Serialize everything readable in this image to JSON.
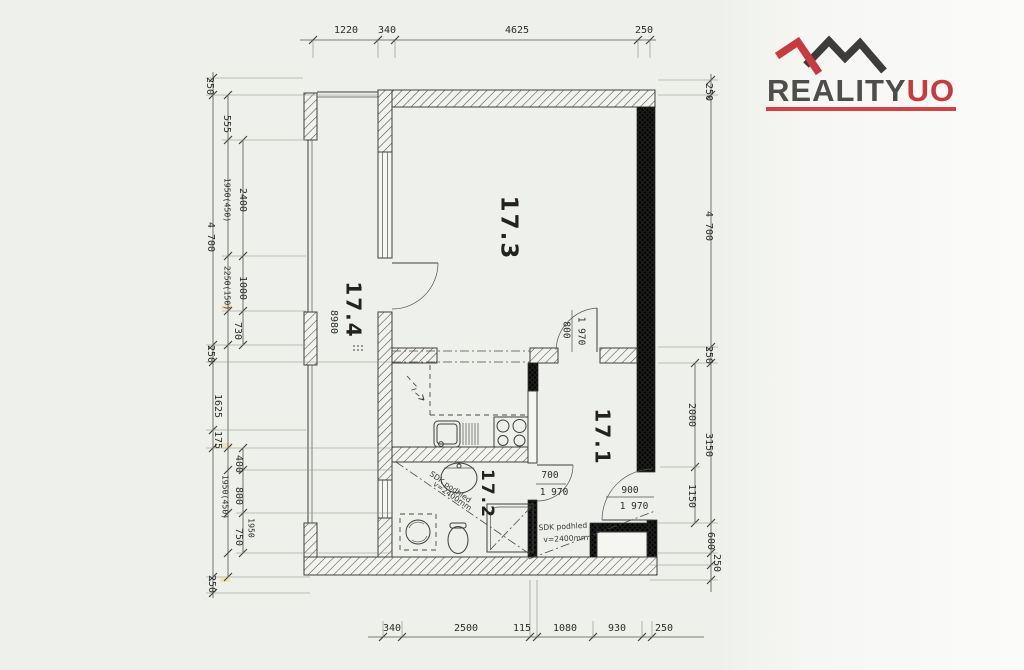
{
  "logo": {
    "brand": "REALITY",
    "accent": "UO",
    "accent_color": "#c93a3c",
    "brand_color": "#4f4c4c"
  },
  "rooms": {
    "living": {
      "label": "17.3"
    },
    "balcony": {
      "label": "17.4",
      "length": "8980"
    },
    "hall": {
      "label": "17.1"
    },
    "bathroom": {
      "label": "17.2"
    }
  },
  "doors": {
    "living": {
      "width": "800",
      "height": "1 970"
    },
    "bathroom": {
      "width": "700",
      "height": "1 970"
    },
    "entry": {
      "width": "900",
      "height": "1 970"
    }
  },
  "notes": {
    "hall": {
      "l1": "SDK podhled",
      "l2": "v=2400mm"
    },
    "bath": {
      "l1": "SDK podhled",
      "l2": "v=2400mm"
    }
  },
  "dims": {
    "top": [
      "1220",
      "340",
      "4625",
      "250"
    ],
    "bottom": [
      "340",
      "2500",
      "115",
      "1080",
      "930",
      "250"
    ],
    "left": [
      "250",
      "555",
      "2400",
      "1950(450)",
      "4 700",
      "1000",
      "2250(150)",
      "730",
      "250",
      "1625",
      "175",
      "400",
      "1950(450)",
      "800",
      "1950",
      "750",
      "250"
    ],
    "right": [
      "250",
      "4 700",
      "250",
      "2000",
      "3150",
      "1150",
      "600",
      "250"
    ]
  }
}
